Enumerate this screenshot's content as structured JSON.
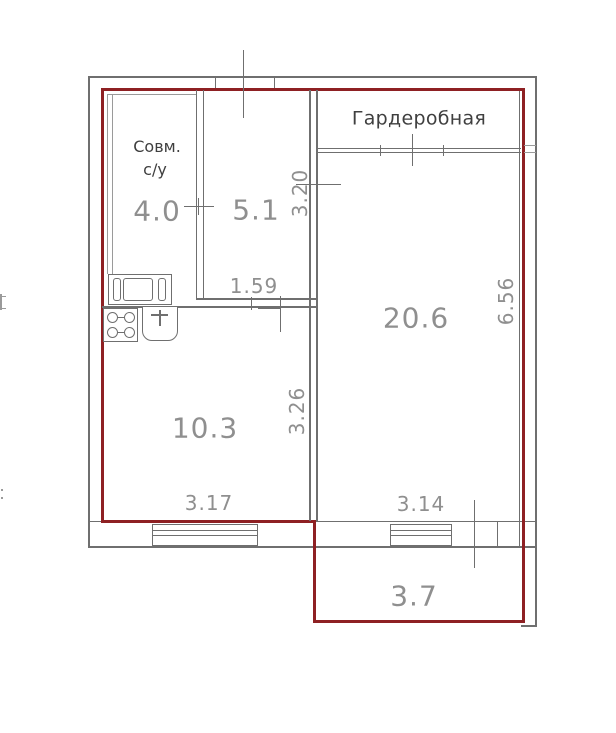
{
  "floor_plan": {
    "labels": {
      "wardrobe": "Гардеробная",
      "bathroom_line1": "Совм.",
      "bathroom_line2": "с/у"
    },
    "room_areas": {
      "bathroom": "4.0",
      "hall": "5.1",
      "living_room": "20.6",
      "kitchen": "10.3",
      "balcony": "3.7"
    },
    "dimensions": {
      "hall_width": "1.59",
      "hall_depth": "3.20",
      "kitchen_depth": "3.26",
      "kitchen_width": "3.17",
      "living_room_width": "3.14",
      "living_room_depth": "6.56"
    },
    "colors": {
      "apartment_boundary": "#8e2023",
      "walls": "#6f6f6f",
      "dimension_text": "#8f8f8f",
      "label_text": "#3f3f3f"
    }
  }
}
